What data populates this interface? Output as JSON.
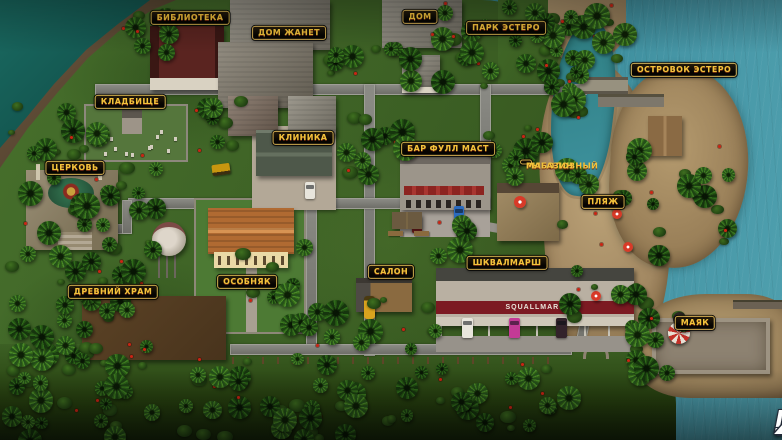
{
  "game_map": {
    "watermark": {
      "mr": "MR",
      "dot": ".",
      "x": "X"
    },
    "squallmart_sign": "SQUALLMART",
    "locations": [
      {
        "id": "library",
        "label": "БИБЛИОТЕКА",
        "x": 190,
        "y": 18
      },
      {
        "id": "janet-house",
        "label": "ДОМ ЖАНЕТ",
        "x": 289,
        "y": 33
      },
      {
        "id": "house",
        "label": "ДОМ",
        "x": 420,
        "y": 17
      },
      {
        "id": "estero-park",
        "label": "ПАРК ЭСТЕРО",
        "x": 506,
        "y": 28
      },
      {
        "id": "estero-islet",
        "label": "ОСТРОВОК ЭСТЕРО",
        "x": 684,
        "y": 70
      },
      {
        "id": "cemetery",
        "label": "КЛАДБИЩЕ",
        "x": 130,
        "y": 102
      },
      {
        "id": "clinic",
        "label": "КЛИНИКА",
        "x": 303,
        "y": 138
      },
      {
        "id": "full-mast-bar",
        "label": "БАР ФУЛЛ МАСТ",
        "x": 448,
        "y": 149
      },
      {
        "id": "fishing-shop",
        "label": "РЫБОЛОВНЫЙ МАГАЗИН",
        "x": 526,
        "y": 162,
        "lines": [
          "РЫБОЛОВНЫЙ",
          "МАГАЗИН"
        ]
      },
      {
        "id": "church",
        "label": "ЦЕРКОВЬ",
        "x": 75,
        "y": 168
      },
      {
        "id": "beach",
        "label": "ПЛЯЖ",
        "x": 603,
        "y": 202
      },
      {
        "id": "ancient-temple",
        "label": "ДРЕВНИЙ ХРАМ",
        "x": 113,
        "y": 292
      },
      {
        "id": "mansion",
        "label": "ОСОБНЯК",
        "x": 247,
        "y": 282
      },
      {
        "id": "salon",
        "label": "САЛОН",
        "x": 391,
        "y": 272
      },
      {
        "id": "squallmart",
        "label": "ШКВАЛМАРШ",
        "x": 507,
        "y": 263
      },
      {
        "id": "lighthouse",
        "label": "МАЯК",
        "x": 695,
        "y": 323
      }
    ],
    "colors": {
      "label_background": "#0c0a05",
      "label_border": "#c9a348",
      "label_text": "#f2c43c",
      "ocean_west": "#1d6b62",
      "ocean_east": "#4797a7",
      "grass": "#3d6125",
      "sand": "#b29a6e",
      "road": "#74746e",
      "squallmart_band": "#7c1a22"
    }
  }
}
